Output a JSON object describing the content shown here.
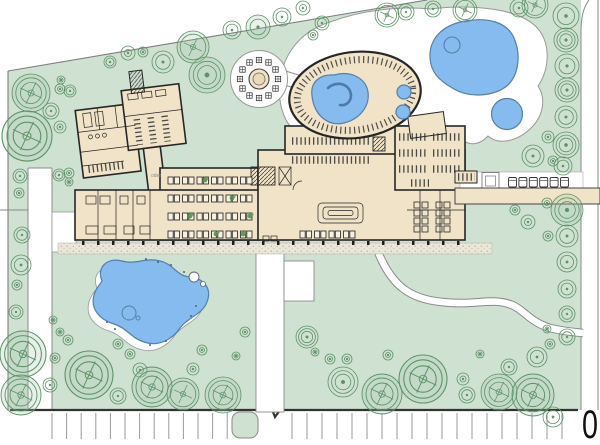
{
  "labels": {
    "scale_zero": "0",
    "tiny_plan_note": "oder"
  },
  "colors": {
    "green": "#cfe1d1",
    "tree": "#5d9267",
    "beige": "#f1e3c8",
    "wall": "#262626",
    "water": "#85bbee",
    "water_line": "#5580a8",
    "road_line": "#8a8a8a",
    "gravel": "#e9e5d6"
  },
  "trees": [
    [
      31,
      93,
      19,
      "c3"
    ],
    [
      27,
      136,
      25,
      "c3"
    ],
    [
      51,
      111,
      8,
      "r2"
    ],
    [
      60,
      89,
      5,
      "d"
    ],
    [
      70,
      91,
      6,
      "r2"
    ],
    [
      61,
      80,
      4,
      "d"
    ],
    [
      60,
      127,
      6,
      "d"
    ],
    [
      20,
      176,
      7,
      "r2"
    ],
    [
      19,
      193,
      5,
      "d"
    ],
    [
      59,
      175,
      6,
      "r2"
    ],
    [
      69,
      173,
      5,
      "d"
    ],
    [
      69,
      182,
      4,
      "d"
    ],
    [
      110,
      62,
      6,
      "r2"
    ],
    [
      128,
      53,
      7,
      "d"
    ],
    [
      143,
      52,
      5,
      "d"
    ],
    [
      163,
      62,
      11,
      "r2"
    ],
    [
      193,
      47,
      16,
      "c2"
    ],
    [
      207,
      75,
      18,
      "r3"
    ],
    [
      232,
      30,
      9,
      "r2"
    ],
    [
      258,
      27,
      12,
      "r2f"
    ],
    [
      282,
      17,
      9,
      "r2"
    ],
    [
      303,
      8,
      7,
      "d"
    ],
    [
      322,
      23,
      7,
      "r2"
    ],
    [
      313,
      35,
      5,
      "d"
    ],
    [
      387,
      15,
      12,
      "c2"
    ],
    [
      406,
      12,
      8,
      "r2"
    ],
    [
      433,
      9,
      8,
      "r2"
    ],
    [
      465,
      10,
      12,
      "c2"
    ],
    [
      519,
      8,
      9,
      "r2"
    ],
    [
      535,
      5,
      13,
      "c2"
    ],
    [
      566,
      16,
      13,
      "r2"
    ],
    [
      566,
      40,
      12,
      "r3"
    ],
    [
      567,
      66,
      12,
      "r2"
    ],
    [
      567,
      90,
      12,
      "r3"
    ],
    [
      566,
      117,
      11,
      "r2"
    ],
    [
      566,
      145,
      13,
      "r3"
    ],
    [
      563,
      166,
      9,
      "r2"
    ],
    [
      553,
      161,
      5,
      "d"
    ],
    [
      548,
      137,
      6,
      "d"
    ],
    [
      533,
      156,
      11,
      "r2"
    ],
    [
      567,
      210,
      16,
      "r3"
    ],
    [
      547,
      203,
      5,
      "d"
    ],
    [
      515,
      210,
      5,
      "d"
    ],
    [
      528,
      222,
      7,
      "d"
    ],
    [
      567,
      236,
      11,
      "r2"
    ],
    [
      548,
      236,
      5,
      "d"
    ],
    [
      567,
      262,
      10,
      "r2"
    ],
    [
      567,
      289,
      9,
      "r2"
    ],
    [
      567,
      314,
      8,
      "r2"
    ],
    [
      567,
      337,
      8,
      "r2"
    ],
    [
      550,
      344,
      5,
      "d"
    ],
    [
      547,
      329,
      4,
      "d"
    ],
    [
      22,
      235,
      8,
      "r2"
    ],
    [
      21,
      265,
      10,
      "r2"
    ],
    [
      17,
      285,
      5,
      "d"
    ],
    [
      16,
      312,
      7,
      "r2"
    ],
    [
      23,
      354,
      23,
      "c3"
    ],
    [
      21,
      395,
      20,
      "c3"
    ],
    [
      50,
      385,
      7,
      "r2"
    ],
    [
      89,
      375,
      24,
      "c3"
    ],
    [
      55,
      358,
      5,
      "d"
    ],
    [
      53,
      320,
      4,
      "d"
    ],
    [
      60,
      332,
      4,
      "d"
    ],
    [
      68,
      340,
      5,
      "d"
    ],
    [
      118,
      344,
      5,
      "d"
    ],
    [
      130,
      354,
      5,
      "d"
    ],
    [
      140,
      370,
      7,
      "d"
    ],
    [
      118,
      396,
      8,
      "r2"
    ],
    [
      152,
      387,
      20,
      "c3"
    ],
    [
      183,
      394,
      16,
      "c2"
    ],
    [
      193,
      369,
      6,
      "d"
    ],
    [
      202,
      350,
      5,
      "d"
    ],
    [
      223,
      395,
      18,
      "c3"
    ],
    [
      236,
      356,
      4,
      "d"
    ],
    [
      245,
      332,
      5,
      "d"
    ],
    [
      307,
      337,
      11,
      "r3"
    ],
    [
      315,
      352,
      4,
      "d"
    ],
    [
      330,
      359,
      5,
      "d"
    ],
    [
      347,
      359,
      5,
      "d"
    ],
    [
      343,
      382,
      15,
      "r3"
    ],
    [
      382,
      394,
      20,
      "c3"
    ],
    [
      388,
      355,
      5,
      "d"
    ],
    [
      423,
      379,
      24,
      "c3"
    ],
    [
      463,
      379,
      6,
      "d"
    ],
    [
      467,
      395,
      8,
      "r2"
    ],
    [
      480,
      354,
      4,
      "d"
    ],
    [
      499,
      392,
      18,
      "c3"
    ],
    [
      509,
      367,
      8,
      "r2"
    ],
    [
      533,
      395,
      21,
      "c3"
    ],
    [
      537,
      357,
      10,
      "r2"
    ],
    [
      553,
      417,
      10,
      "r2"
    ]
  ],
  "parking_rows": [
    {
      "x1": 52,
      "x2": 228,
      "step": 14.6,
      "y1": 413,
      "y2": 439
    },
    {
      "x1": 292,
      "x2": 576,
      "step": 15,
      "y1": 413,
      "y2": 439
    }
  ],
  "column_rows": [
    {
      "x1": 82,
      "x2": 457,
      "step": 15,
      "y": 241,
      "w": 2.5,
      "h": 4
    },
    {
      "x1": 462,
      "x2": 594,
      "step": 16,
      "y": 188,
      "w": 2,
      "h": 3.5
    }
  ],
  "building": {
    "table_grids": [
      {
        "x": 168,
        "rows": [
          177,
          195,
          213,
          231
        ],
        "units": 6
      },
      {
        "x": 300,
        "rows": [
          231
        ],
        "units": 4
      }
    ],
    "locker_rows": [
      [
        292,
        141,
        370
      ],
      [
        292,
        160,
        370
      ],
      [
        399,
        137,
        427
      ],
      [
        399,
        153,
        427
      ],
      [
        399,
        169,
        427
      ],
      [
        433,
        137,
        461
      ],
      [
        433,
        153,
        461
      ],
      [
        433,
        169,
        461
      ],
      [
        411,
        183,
        429
      ]
    ],
    "plants": [
      [
        190,
        216
      ],
      [
        216,
        234
      ],
      [
        232,
        198
      ],
      [
        250,
        216
      ],
      [
        205,
        180
      ],
      [
        243,
        234
      ]
    ]
  },
  "pavilion": {
    "cx": 259,
    "cy": 79,
    "ring_r": 19,
    "count": 12,
    "size": 5.4
  },
  "loungers": {
    "x": 508.5,
    "y": 177.5,
    "w": 8,
    "h": 9.5,
    "gap": 2.4,
    "count": 6
  },
  "pond_stones": [
    [
      146,
      259
    ],
    [
      158,
      262
    ],
    [
      171,
      265
    ],
    [
      184,
      272
    ],
    [
      107,
      322
    ],
    [
      115,
      329
    ],
    [
      150,
      345
    ],
    [
      166,
      341
    ],
    [
      196,
      306
    ],
    [
      191,
      316
    ]
  ]
}
